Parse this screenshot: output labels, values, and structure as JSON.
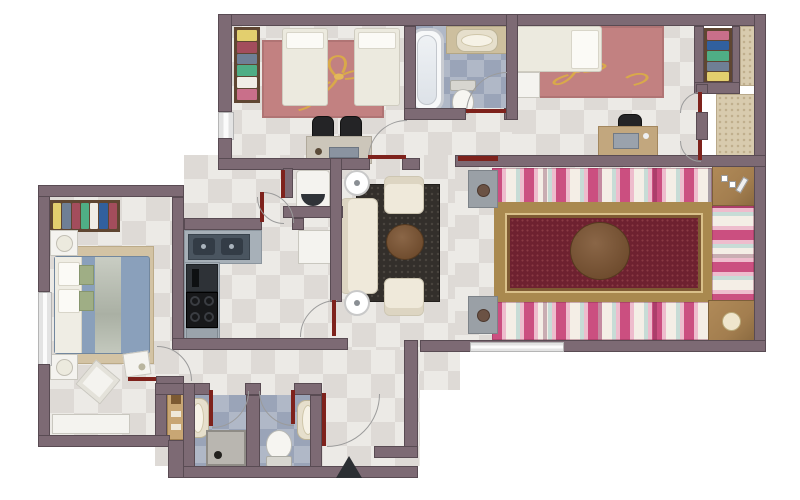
{
  "meta": {
    "type": "apartment-floor-plan",
    "view": "top-down-rendered",
    "canvas": {
      "width": 800,
      "height": 500
    },
    "visible_text": "none"
  },
  "colors": {
    "wall": "#7d6a74",
    "wall-edge": "#594b53",
    "door-leaf": "#7e221c",
    "arc": "#9b9b9b",
    "tile-a": "#eceae6",
    "tile-b": "#dedad6",
    "bath-tile-a": "#b0b8c7",
    "bath-tile-b": "#9aa4b8",
    "balcony-floor": "#d8cbae",
    "balcony-dot": "#bfae8c",
    "rose-rug": "#c28181",
    "rug-gold": "#d9a94a",
    "carpet-field": "#6e2130",
    "carpet-border": "#a9894f",
    "carpet-dot": "#8a3a44",
    "cushion-pink": "#cb4f80",
    "cushion-lightpink": "#eebccd",
    "cushion-cream": "#f4eee6",
    "cushion-mint": "#c7dcd6",
    "wood": "#a37e4f",
    "wood-dark": "#6f4c2e",
    "cream-sofa": "#efe9da",
    "sofa-edge": "#cdc6b2",
    "lounge-rug": "#332f2b",
    "lounge-rug-dot": "#4a453f",
    "counter": "#a7b0b8",
    "sink-dark": "#4a5560",
    "basin": "#333c46",
    "stove": "#17181a",
    "oven": "#2e3237",
    "white-furn": "#f4f3ef",
    "furn-edge": "#c9c7bf",
    "master-duvet": "#8aa0bb",
    "master-green": "#9fae85",
    "master-rug": "#d3c3a4",
    "tan-counter": "#cdbf9e",
    "sink-beige": "#e6dfcc",
    "shower-gray": "#b9b6b0",
    "wardrobe-frame": "#5f4632",
    "marker": "#2c2f33",
    "clothes": [
      "#e3cf6e",
      "#a34d5c",
      "#6f7f95",
      "#4fae85",
      "#f0ede6",
      "#c96f8a",
      "#31609e",
      "#8f9aa8"
    ]
  },
  "rooms": [
    {
      "id": "kids-bedroom",
      "label": "Kids Bedroom",
      "position": "top-left",
      "furniture": [
        "wardrobe-with-clothes",
        "twin-bed",
        "twin-bed",
        "rose-area-rug-with-gold-flower",
        "study-desk",
        "desk-chair",
        "desk-chair"
      ]
    },
    {
      "id": "family-bathroom",
      "label": "Bathroom",
      "position": "top-center",
      "furniture": [
        "bathtub",
        "counter-washbasin",
        "toilet"
      ]
    },
    {
      "id": "bedroom-2",
      "label": "Bedroom 2",
      "position": "top-right",
      "furniture": [
        "single-bed",
        "nightstand",
        "rose-area-rug-with-gold-flower",
        "computer-desk",
        "office-chair",
        "wardrobe-with-clothes"
      ]
    },
    {
      "id": "balcony",
      "label": "Balcony",
      "position": "right-edge",
      "furniture": [
        "stone-textured-floor",
        "double-french-doors"
      ]
    },
    {
      "id": "majlis-living-room",
      "label": "Majlis Living Room",
      "position": "right",
      "furniture": [
        "striped-floor-cushions-top",
        "striped-floor-cushions-bottom",
        "striped-floor-cushions-right",
        "oriental-red-carpet",
        "round-center-table",
        "corner-wood-table-with-games",
        "corner-wood-table-with-tray",
        "gray-side-stand",
        "gray-side-stand"
      ]
    },
    {
      "id": "family-hall",
      "label": "Family Hall / Lounge",
      "position": "center",
      "furniture": [
        "three-seat-sofa",
        "armchair",
        "armchair",
        "round-coffee-table",
        "dark-area-rug",
        "round-side-lamp",
        "round-side-lamp",
        "white-side-table"
      ]
    },
    {
      "id": "kitchen",
      "label": "Kitchen",
      "position": "center-left",
      "furniture": [
        "double-sink-counter",
        "built-in-oven",
        "four-burner-cooktop",
        "drawer-unit"
      ]
    },
    {
      "id": "laundry-niche",
      "label": "Laundry Niche",
      "position": "center",
      "furniture": [
        "washing-machine"
      ]
    },
    {
      "id": "master-bedroom",
      "label": "Master Bedroom",
      "position": "left",
      "furniture": [
        "double-bed-blue-bedding",
        "nightstand",
        "nightstand",
        "wardrobe-with-clothes",
        "tan-area-rug",
        "rotated-corner-table",
        "small-storage-box",
        "low-dresser"
      ]
    },
    {
      "id": "shower-room",
      "label": "Shower Room",
      "position": "bottom-center-left",
      "furniture": [
        "wall-washbasin",
        "shower-tray",
        "wooden-storage-shelf"
      ]
    },
    {
      "id": "wc",
      "label": "WC",
      "position": "bottom-center",
      "furniture": [
        "wall-washbasin",
        "toilet"
      ]
    },
    {
      "id": "entry",
      "label": "Entrance",
      "position": "bottom",
      "furniture": [
        "entrance-door"
      ]
    }
  ],
  "markers": {
    "entrance_arrow": "black triangle below entrance wall pointing up"
  }
}
